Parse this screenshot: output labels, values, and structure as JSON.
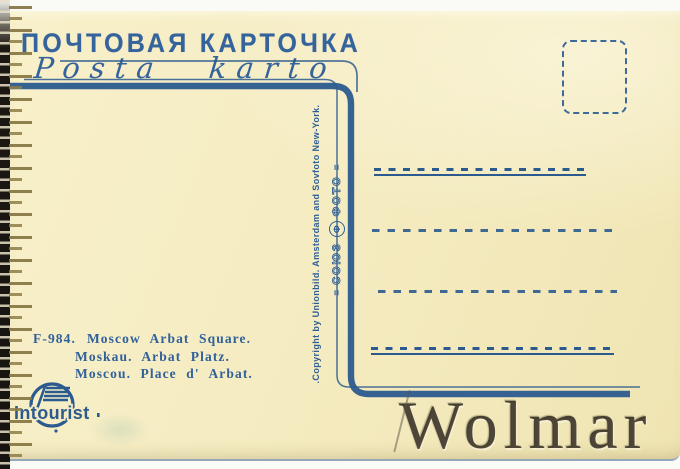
{
  "postcard": {
    "header": {
      "title_ru": "ПОЧТОВАЯ КАРТОЧКА",
      "title_eo": "Posta karto"
    },
    "vertical": {
      "copyright": ".Copyright by Unionbild. Amsterdam and Sovfoto New-York.",
      "agency_word1": "СОЮЗ",
      "agency_word2": "ФОТО",
      "agency_monogram": "Φ",
      "flourish": "="
    },
    "caption": {
      "code": "F-984.",
      "line_en": "Moscow Arbat Square.",
      "line_de": "Moskau.  Arbat Platz.",
      "line_fr": "Moscou.  Place d' Arbat."
    },
    "brand": {
      "intourist": "Intourist"
    },
    "watermark": "Wolmar",
    "colors": {
      "ink_text": "#35639b",
      "ink_lines": "#2b5a8e",
      "card_paper": "#f5ecc2",
      "edge_ticks": "#837340"
    }
  }
}
